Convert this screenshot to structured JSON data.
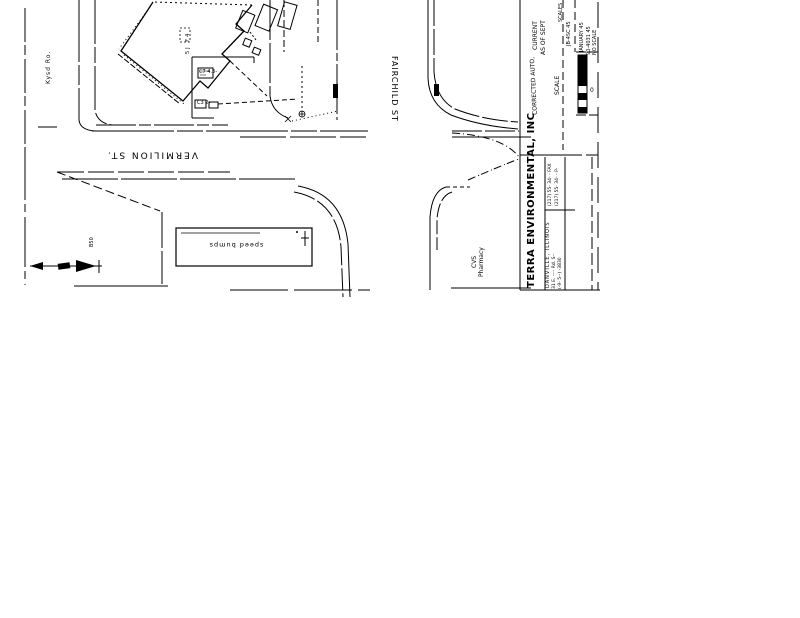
{
  "map": {
    "street_vermilion": "VERMILION ST.",
    "street_fairchild": "FAIRCHILD ST",
    "side_road": "Kysd Ro.",
    "building_label": "5J F4",
    "annotation_c7": "C7 4.3-",
    "annotation_c3": "C3 2-",
    "parking_label": "speed bumps",
    "b50_label": "B50",
    "cvs_line1": "CVS",
    "cvs_line2": "Pharmacy"
  },
  "title_block": {
    "current": "CURRENT",
    "as_of": "AS OF SEPT",
    "corrected": "CORRECTED AUTO,",
    "scale_label": "SCALE",
    "scale_label2": "SCALES",
    "ref1": "JB-4SC 45",
    "date": "JANUARY 45",
    "job_no": "90-4031 45",
    "no_scale": "NO SCALE",
    "scale_zero": "0",
    "company": "TERRA ENVIRONMENTAL, INC",
    "city": "DANVILLE, ILLINOIS",
    "address1": "31 E. ---- Rd. S--",
    "address2": "(-9- 5--) -3830",
    "fax": "(217) 55- 34- - FAX",
    "phone": "(217) 55- 34- - P-"
  }
}
